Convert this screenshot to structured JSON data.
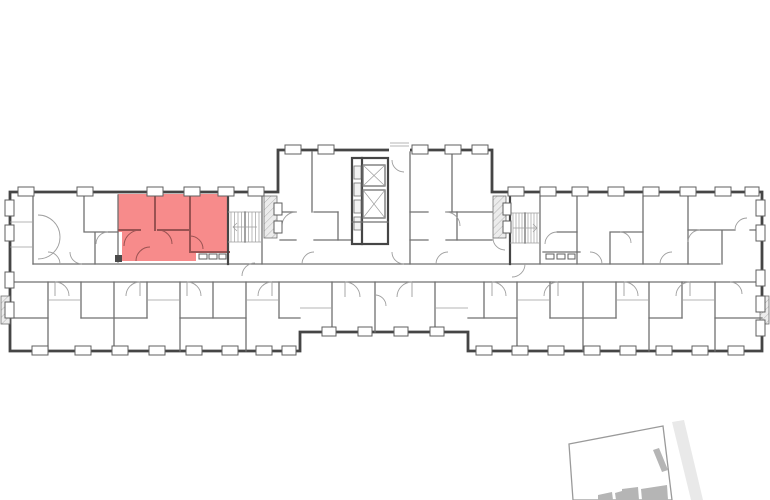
{
  "view": {
    "kind": "apartment-floor-plan",
    "has_text_labels": false
  },
  "colors": {
    "background": "#ffffff",
    "outer_wall": "#454545",
    "inner_wall": "#707070",
    "thin_line": "#9e9e9e",
    "window_stroke": "#5f5f5f",
    "shaft_fill": "#f2f2f2",
    "dark_mark": "#4a4a4a",
    "highlight_fill": "#f78b8b",
    "highlight_wall": "#9a5252",
    "hatch_bg": "#ececec",
    "hatch_line": "#b2b2b2",
    "minimap_boundary": "#9a9a9a",
    "minimap_building": "#b5b5b5",
    "minimap_road": "#e9e9e9"
  }
}
